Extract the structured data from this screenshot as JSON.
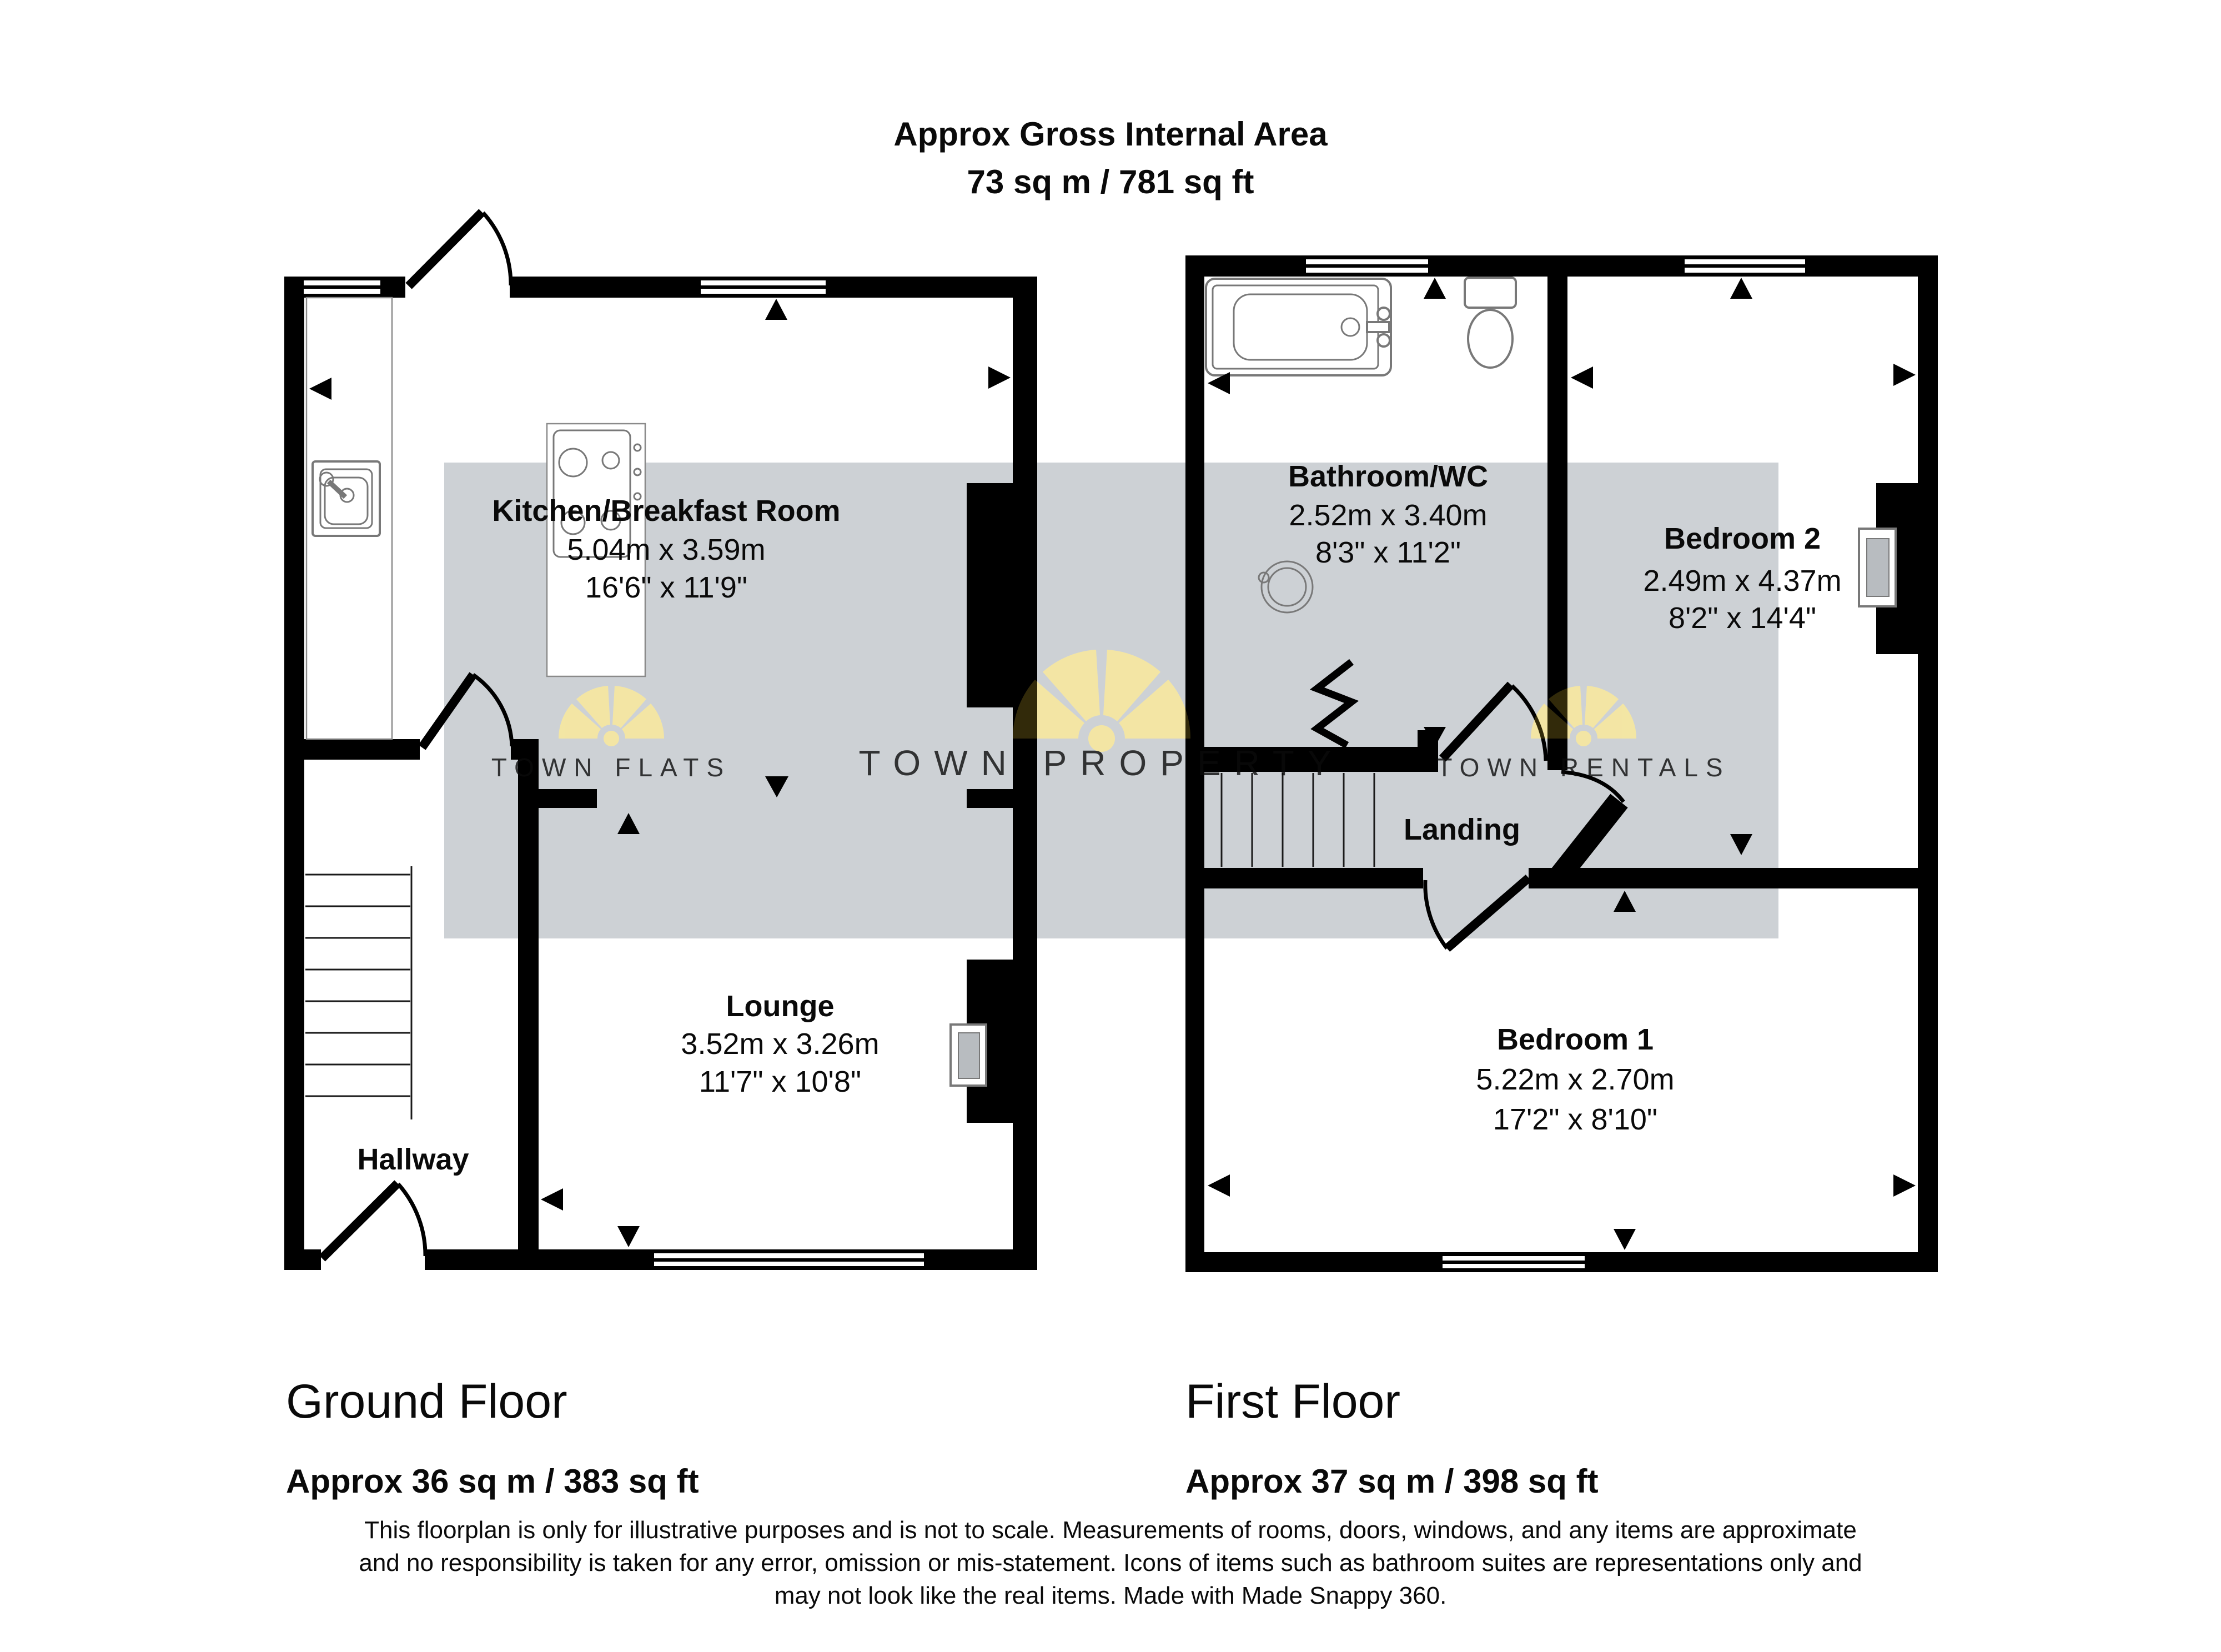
{
  "header": {
    "title": "Approx Gross Internal Area",
    "area": "73 sq m / 781 sq ft"
  },
  "ground_floor": {
    "name": "Ground Floor",
    "area": "Approx 36 sq m / 383 sq ft",
    "rooms": {
      "kitchen": {
        "name": "Kitchen/Breakfast Room",
        "metric": "5.04m x 3.59m",
        "imperial": "16'6\" x 11'9\""
      },
      "lounge": {
        "name": "Lounge",
        "metric": "3.52m x 3.26m",
        "imperial": "11'7\" x 10'8\""
      },
      "hallway": {
        "name": "Hallway"
      }
    }
  },
  "first_floor": {
    "name": "First Floor",
    "area": "Approx 37 sq m / 398 sq ft",
    "rooms": {
      "bathroom": {
        "name": "Bathroom/WC",
        "metric": "2.52m x 3.40m",
        "imperial": "8'3\" x 11'2\""
      },
      "bedroom2": {
        "name": "Bedroom 2",
        "metric": "2.49m x 4.37m",
        "imperial": "8'2\" x 14'4\""
      },
      "bedroom1": {
        "name": "Bedroom 1",
        "metric": "5.22m x 2.70m",
        "imperial": "17'2\" x 8'10\""
      },
      "landing": {
        "name": "Landing"
      }
    }
  },
  "watermarks": {
    "left": "TOWN FLATS",
    "center": "TOWN PROPERTY",
    "right": "TOWN RENTALS"
  },
  "disclaimer": {
    "line1": "This floorplan is only for illustrative purposes and is not to scale. Measurements of rooms, doors, windows, and any items are approximate",
    "line2": "and no responsibility is taken for any error, omission or mis-statement. Icons of items such as bathroom suites are representations only and",
    "line3": "may not look like the real items. Made with Made Snappy 360."
  },
  "colors": {
    "wall": "#000000",
    "band": "#cdd1d5",
    "logo_yellow": "#F8F1C6",
    "logo_tint": "#E3BF2E",
    "watermark_text": "#ffffff"
  }
}
